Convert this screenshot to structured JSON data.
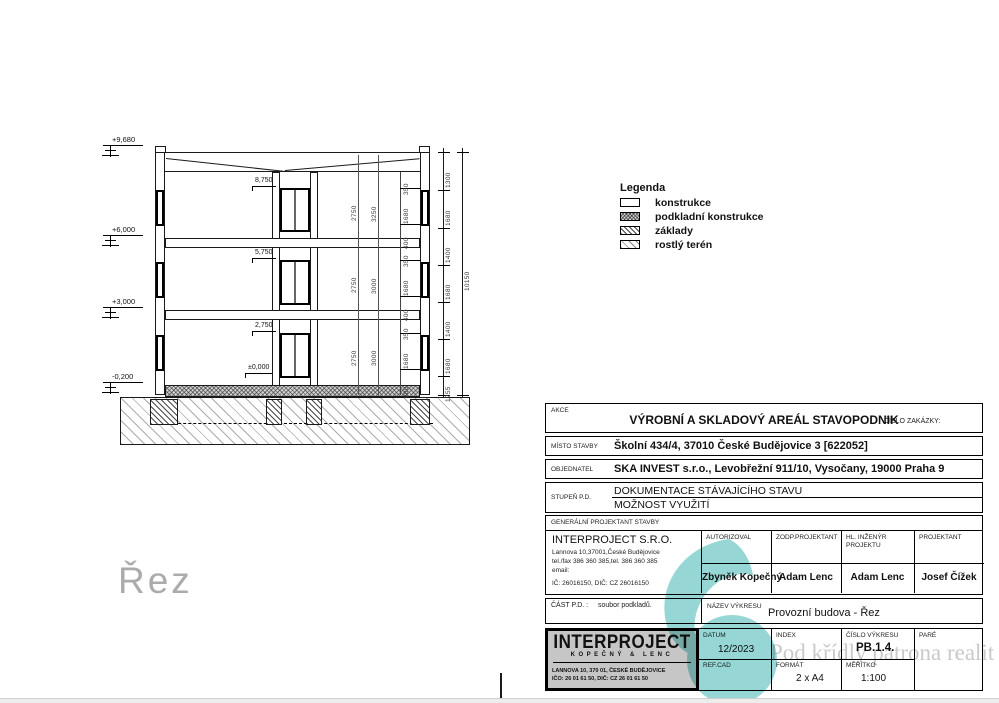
{
  "page": {
    "watermark_text": "Pod křídly patrona realit"
  },
  "drawing": {
    "section_label": "Řez",
    "levels_left": [
      "+9,680",
      "+6,000",
      "+3,000",
      "-0,200"
    ],
    "levels_inner": [
      "8,750",
      "5,750",
      "2,750",
      "±0,000"
    ],
    "dims": {
      "outer_chain": [
        "1300",
        "1680",
        "1400",
        "1680",
        "1400",
        "1680",
        "1255"
      ],
      "overall": "10150",
      "room_left": [
        "2750",
        "2750",
        "2750"
      ],
      "room_right": [
        "3250",
        "3000",
        "3000"
      ],
      "window_chain": [
        "350",
        "1680",
        "400",
        "350",
        "1680",
        "400",
        "350",
        "1680",
        "800"
      ]
    }
  },
  "legend": {
    "title": "Legenda",
    "items": [
      {
        "label": "konstrukce"
      },
      {
        "label": "podkladní konstrukce"
      },
      {
        "label": "základy"
      },
      {
        "label": "rostlý terén"
      }
    ]
  },
  "titleblock": {
    "akce_label": "AKCE",
    "akce_value": "VÝROBNÍ A SKLADOVÝ AREÁL STAVOPODNIK",
    "cislo_zakazky_label": "ČÍSLO ZAKÁZKY:",
    "misto_label": "MÍSTO STAVBY",
    "misto_value": "Školní 434/4, 37010 České Budějovice 3 [622052]",
    "objednatel_label": "OBJEDNATEL",
    "objednatel_value": "SKA INVEST s.r.o., Levobřežní 911/10, Vysočany, 19000 Praha 9",
    "stupen_label": "STUPEŇ P.D.",
    "stupen_value1": "DOKUMENTACE STÁVAJÍCÍHO STAVU",
    "stupen_value2": "MOŽNOST VYUŽITÍ",
    "gen_projektant_label": "GENERÁLNÍ PROJEKTANT STAVBY",
    "company": {
      "name": "INTERPROJECT S.R.O.",
      "line1": "Lannova 10,37001,České Budějovice",
      "line2": "tel./fax 386 360 385,tel. 386 360 385",
      "line3": "email:",
      "line4": "IČ: 26016150, DIČ: CZ 26016150"
    },
    "roles": [
      {
        "label": "AUTORIZOVAL",
        "name": "Zbyněk Kopečný"
      },
      {
        "label": "ZODP.PROJEKTANT",
        "name": "Adam Lenc"
      },
      {
        "label": "HL. INŽENÝR PROJEKTU",
        "name": "Adam Lenc"
      },
      {
        "label": "PROJEKTANT",
        "name": "Josef Čížek"
      }
    ],
    "cast_pd_label": "ČÁST P.D. :",
    "cast_pd_value": "soubor podkladů.",
    "nazev_label": "NÁZEV VÝKRESU",
    "nazev_value": "Provozní budova - Řez",
    "logo": {
      "name": "INTERPROJECT",
      "sub": "KOPEČNÝ & LENC",
      "addr": "LANNOVA 10, 370 01, ČESKÉ BUDĚJOVICE",
      "ids": "IČO: 26 01 61 50,   DIČ: CZ 26 01 61 50"
    },
    "datum_label": "DATUM",
    "datum_value": "12/2023",
    "index_label": "INDEX",
    "cislo_vykresu_label": "ČÍSLO VÝKRESU",
    "cislo_vykresu_value": "PB.1.4.",
    "pare_label": "PARÉ",
    "refcad_label": "REF.CAD",
    "format_label": "FORMÁT",
    "format_value": "2 x A4",
    "meritko_label": "MĚŘÍTKO",
    "meritko_value": "1:100"
  },
  "colors": {
    "watermark_teal": "#3fb6b2",
    "watermark_gray": "#c9c9c9",
    "logo_bg": "#c6c6c6"
  }
}
